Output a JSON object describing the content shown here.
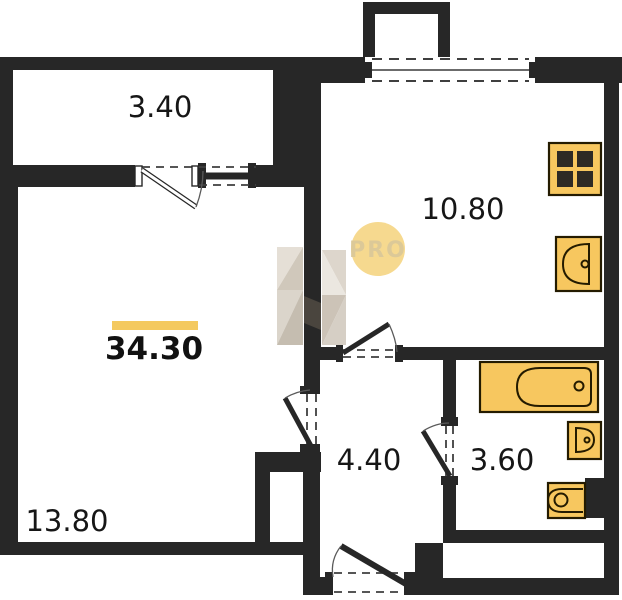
{
  "plan": {
    "type": "apartment-floor-plan"
  },
  "rooms": {
    "balcony": {
      "area": "3.40"
    },
    "kitchen": {
      "area": "10.80"
    },
    "living": {
      "area": "13.80"
    },
    "hallway": {
      "area": "4.40"
    },
    "bathroom": {
      "area": "3.60"
    }
  },
  "total": {
    "area": "34.30"
  },
  "watermark": {
    "badge": "PRO"
  },
  "fixtures": {
    "stove": "stove-icon",
    "kitchen_sink": "kitchen-sink-icon",
    "bathtub": "bathtub-icon",
    "bathroom_sink": "bathroom-sink-icon",
    "toilet": "toilet-icon"
  },
  "colors": {
    "background": "#FFFFFF",
    "wall": "#272727",
    "fixture_fill": "#F7C75F",
    "fixture_stroke": "#241B00",
    "accent_bar": "#F4C95F",
    "watermark_circle": "#F6D98F",
    "watermark_text": "#DCC998"
  }
}
